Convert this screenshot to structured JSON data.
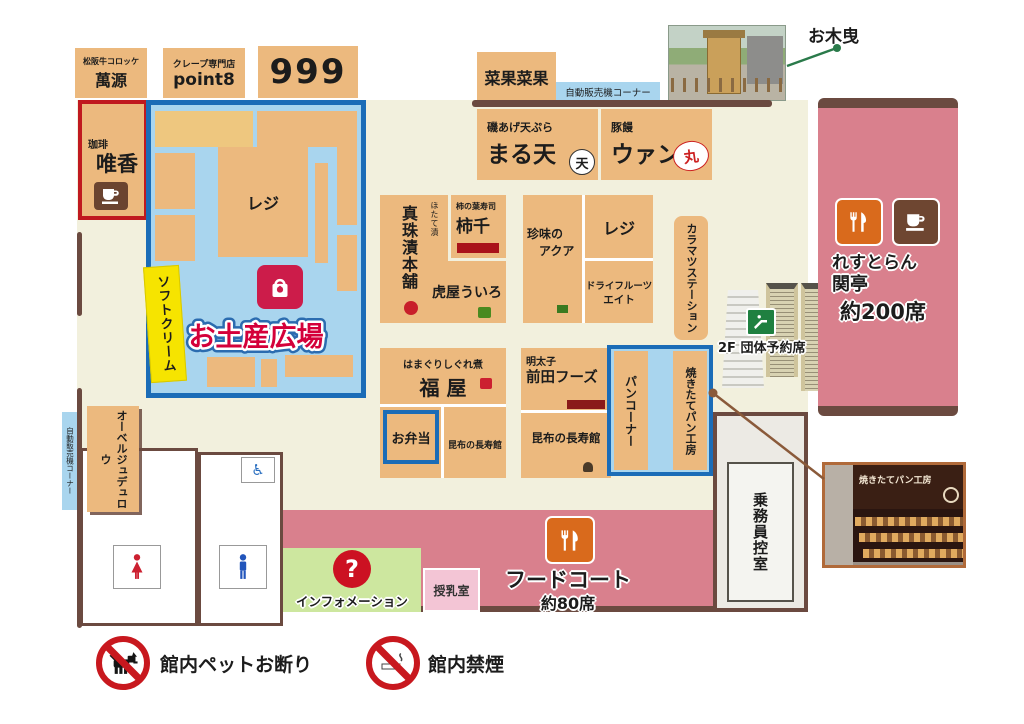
{
  "top_shops": {
    "mangen": {
      "sub": "松阪牛コロッケ",
      "name": "萬源"
    },
    "point8": {
      "sub": "クレープ専門店",
      "name": "point8"
    },
    "shop999": {
      "name": "999"
    },
    "saikasaika": {
      "name": "菜果菜果"
    },
    "vending": {
      "label": "自動販売機コーナー"
    }
  },
  "okihiki": {
    "label": "お木曳"
  },
  "coffee": {
    "sub": "珈琲",
    "name": "唯香"
  },
  "souvenir": {
    "title": "お土産広場",
    "register": "レジ",
    "softcream": "ソフトクリーム"
  },
  "maruten": {
    "sub": "磯あげ天ぷら",
    "name": "まる天",
    "logo": "天"
  },
  "wan": {
    "sub": "豚饅",
    "name": "ウァン",
    "logo": "丸"
  },
  "center": {
    "shinju": {
      "sub": "ほたて漬",
      "name": "真珠漬本舗"
    },
    "kakisen": {
      "sub": "柿の葉寿司",
      "name": "柿千"
    },
    "toraya": {
      "name": "虎屋ういろ"
    },
    "aqua": {
      "line1": "珍味の",
      "line2": "アクア"
    },
    "register": "レジ",
    "dryfruits": {
      "line1": "ドライフルーツ",
      "line2": "エイト"
    },
    "karamatsu": "カラマツステーション"
  },
  "lower": {
    "fukuya": {
      "sub": "はまぐりしぐれ煮",
      "name": "福 屋"
    },
    "obento": "お弁当",
    "kombu1": "昆布の長寿館",
    "maeda": {
      "sub": "明太子",
      "name": "前田フーズ"
    },
    "kombu2": "昆布の長寿館",
    "pan_corner": "パンコーナー",
    "pan_factory": "焼きたてパン工房"
  },
  "escalator": {
    "label": "2F 団体予約席"
  },
  "restaurant": {
    "line1": "れすとらん",
    "line2": "関亭",
    "seats": "約200席"
  },
  "left_side": {
    "vending": "自動販売機コーナー",
    "auberge": "オーベルジュデュロウ"
  },
  "crew_room": {
    "name": "乗務員控室"
  },
  "foodcourt": {
    "name": "フードコート",
    "seats": "約80席"
  },
  "info": {
    "label": "インフォメーション"
  },
  "nursing": {
    "label": "授乳室"
  },
  "bakery_photo": {
    "sign": "焼きたてパン工房"
  },
  "notices": {
    "pets": "館内ペットお断り",
    "smoking": "館内禁煙"
  },
  "colors": {
    "shop_tan": "#ecb97e",
    "floor_cream": "#f2f0dd",
    "plaza_border_blue": "#1b6cb7",
    "walkway_blue": "#a9d5ee",
    "pink": "#d9808d",
    "wall_brown": "#6b4a40",
    "coffee_red_border": "#c0191f",
    "softcream_yellow": "#f6e400",
    "info_green": "#cde79f",
    "nursing_pink": "#f3c5d5",
    "title_red": "#d4003a",
    "icon_orange": "#d96a1c",
    "icon_coffee_brown": "#6e4631",
    "sign_green": "#1f8040"
  }
}
